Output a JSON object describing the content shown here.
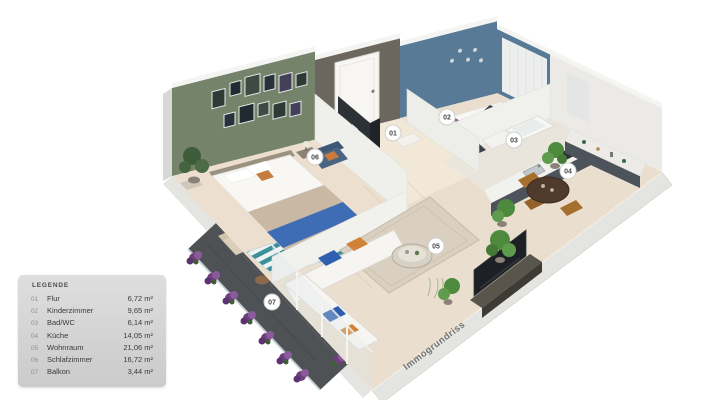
{
  "legend": {
    "title": "LEGENDE",
    "items": [
      {
        "number": "01",
        "label": "Flur",
        "area": "6,72 m²"
      },
      {
        "number": "02",
        "label": "Kinderzimmer",
        "area": "9,65 m²"
      },
      {
        "number": "03",
        "label": "Bad/WC",
        "area": "6,14 m²"
      },
      {
        "number": "04",
        "label": "Küche",
        "area": "14,05 m²"
      },
      {
        "number": "05",
        "label": "Wohnraum",
        "area": "21,06 m²"
      },
      {
        "number": "06",
        "label": "Schlafzimmer",
        "area": "16,72 m²"
      },
      {
        "number": "07",
        "label": "Balkon",
        "area": "3,44 m²"
      }
    ]
  },
  "watermark": {
    "text": "Immogrundriss"
  },
  "plan": {
    "badges": [
      {
        "label": "01",
        "room": "Flur"
      },
      {
        "label": "02",
        "room": "Kinderzimmer"
      },
      {
        "label": "03",
        "room": "Bad/WC"
      },
      {
        "label": "04",
        "room": "Küche"
      },
      {
        "label": "05",
        "room": "Wohnraum"
      },
      {
        "label": "06",
        "room": "Schlafzimmer"
      },
      {
        "label": "07",
        "room": "Balkon"
      }
    ]
  },
  "colors": {
    "bedroomWall": "#75836b",
    "hallWall": "#6b675f",
    "kidsWall": "#587a96",
    "wallCap": "#f4f4f2",
    "exteriorWall": "#e4e4e1",
    "floor": "#eadfcf",
    "hallFloor": "#f3ead9",
    "balconyFloor": "#4f5254",
    "sofa": "#f6f5f2",
    "accentBlue": "#2f5fae",
    "accentOrange": "#d08238",
    "bedBlue": "#3f6db5",
    "rugTeal": "#3d8f99",
    "kidBedding": "#9b6e92",
    "flowerPurple": "#6e3f7d",
    "plantGreen": "#4e8a3d",
    "woodBrown": "#4f3a2b",
    "counterDark": "#4d535b",
    "tvScreen": "#1d2125",
    "badgeBg": "#ffffff",
    "badgeText": "#4a4a4a",
    "watermarkColor": "#606060"
  }
}
